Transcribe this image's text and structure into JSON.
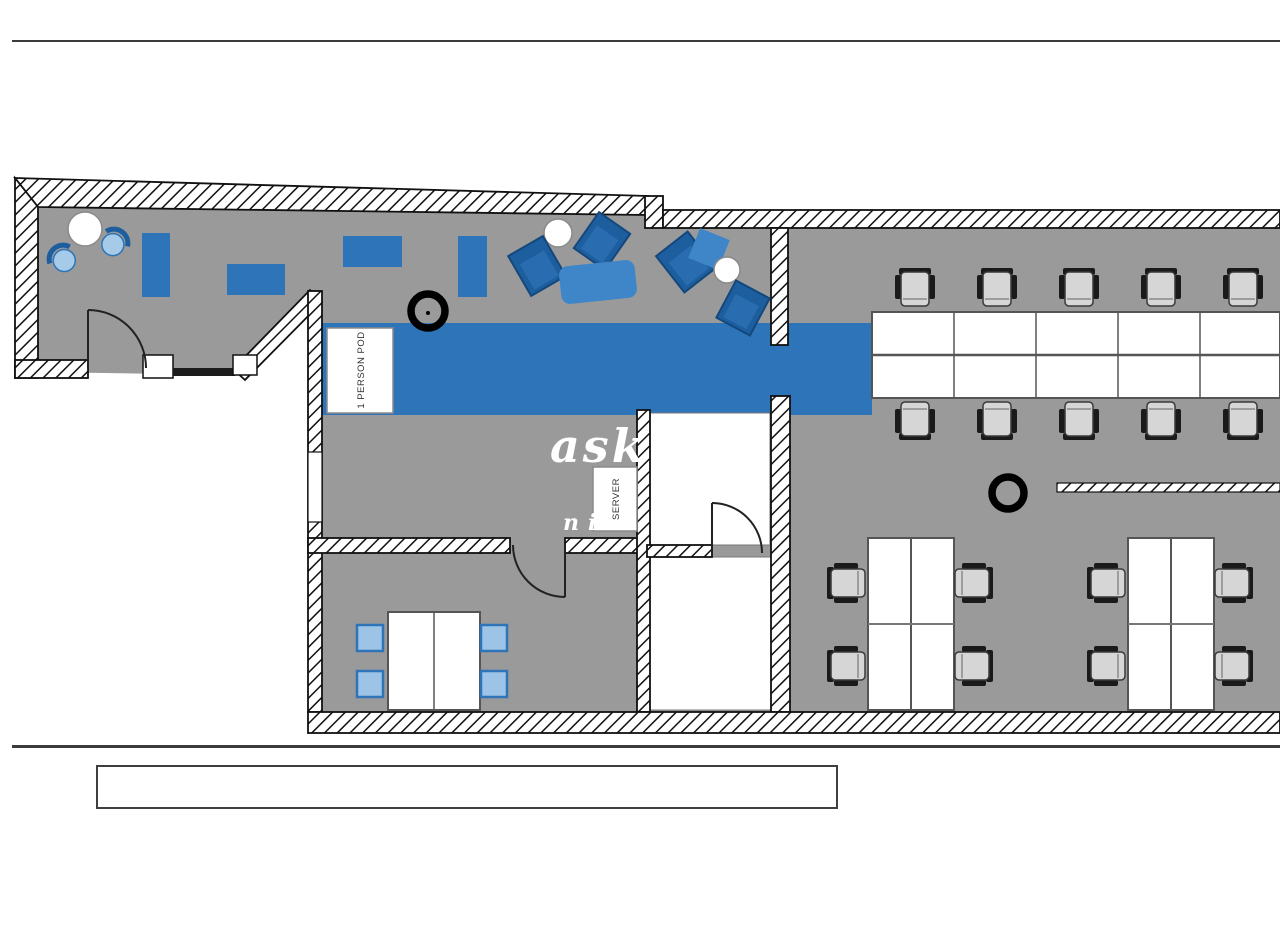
{
  "document": {
    "type": "office floor plan drawing",
    "caption_box_text": ""
  },
  "plan": {
    "labels": {
      "pod": "1 PERSON POD",
      "server": "SERVER"
    },
    "watermark": {
      "line1": "ask o",
      "line2": "ni k"
    },
    "annotations": {
      "markers": [
        {
          "name": "ring-marker-1",
          "x": 428,
          "y": 311
        },
        {
          "name": "ring-marker-2",
          "x": 1008,
          "y": 493
        }
      ]
    },
    "colors": {
      "floor_gray": "#9a9a9a",
      "corridor_blue": "#2e74b8",
      "desk_blue": "#2e74b8",
      "light_chair_blue": "#9dc3e6",
      "lounge_chair_blue": "#1d5e9e",
      "sofa_blue": "#3f86c9",
      "wall_outline": "#111111",
      "office_chair_gray": "#d6d6d6"
    },
    "inventory": {
      "desk_bank_seats_top": 5,
      "desk_bank_seats_bottom": 5,
      "quad_clusters": 2,
      "seats_per_quad": 4,
      "meeting_table_chairs": 4,
      "lounge_blue_desks": 4,
      "round_tables": 3
    }
  }
}
